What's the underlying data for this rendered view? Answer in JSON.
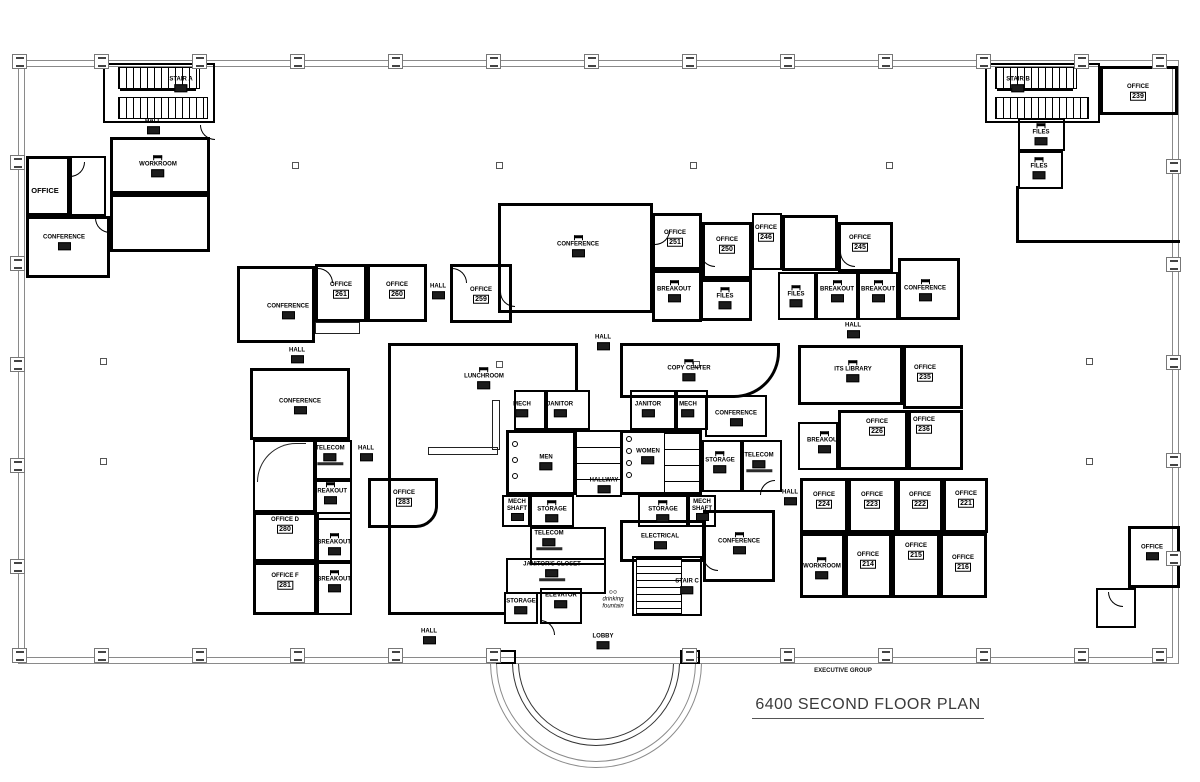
{
  "meta": {
    "title": "6400 SECOND FLOOR PLAN",
    "building_label": "EXECUTIVE GROUP"
  },
  "plan": {
    "labels": [
      {
        "name": "STAIR A",
        "x": 181,
        "y": 84,
        "num": ""
      },
      {
        "name": "HALL",
        "x": 153,
        "y": 126,
        "num": ""
      },
      {
        "name": "WORKROOM",
        "x": 158,
        "y": 166,
        "num": "",
        "icon": "desk"
      },
      {
        "name": "OFFICE",
        "x": 45,
        "y": 191,
        "big": true
      },
      {
        "name": "CONFERENCE",
        "x": 64,
        "y": 242,
        "num": ""
      },
      {
        "name": "STAIR B",
        "x": 1018,
        "y": 84,
        "num": ""
      },
      {
        "name": "OFFICE",
        "x": 1138,
        "y": 92,
        "num": "239"
      },
      {
        "name": "FILES",
        "x": 1041,
        "y": 134,
        "num": "",
        "icon": "desk"
      },
      {
        "name": "FILES",
        "x": 1039,
        "y": 168,
        "num": "",
        "icon": "desk"
      },
      {
        "name": "CONFERENCE",
        "x": 288,
        "y": 311,
        "num": ""
      },
      {
        "name": "OFFICE",
        "x": 341,
        "y": 290,
        "num": "261"
      },
      {
        "name": "OFFICE",
        "x": 397,
        "y": 290,
        "num": "260"
      },
      {
        "name": "HALL",
        "x": 438,
        "y": 291,
        "num": ""
      },
      {
        "name": "OFFICE",
        "x": 481,
        "y": 295,
        "num": "259"
      },
      {
        "name": "HALL",
        "x": 297,
        "y": 355,
        "num": ""
      },
      {
        "name": "CONFERENCE",
        "x": 300,
        "y": 406,
        "num": ""
      },
      {
        "name": "TELECOM",
        "x": 330,
        "y": 455,
        "num": "",
        "sub": true
      },
      {
        "name": "BREAKOUT",
        "x": 330,
        "y": 493,
        "num": "",
        "icon": "desk"
      },
      {
        "name": "OFFICE D",
        "x": 285,
        "y": 525,
        "num": "280"
      },
      {
        "name": "BREAKOUT",
        "x": 334,
        "y": 544,
        "num": "",
        "icon": "desk"
      },
      {
        "name": "OFFICE F",
        "x": 285,
        "y": 581,
        "num": "281"
      },
      {
        "name": "BREAKOUT",
        "x": 334,
        "y": 581,
        "num": "",
        "icon": "desk"
      },
      {
        "name": "HALL",
        "x": 366,
        "y": 453,
        "num": ""
      },
      {
        "name": "OFFICE",
        "x": 404,
        "y": 498,
        "num": "283"
      },
      {
        "name": "CONFERENCE",
        "x": 578,
        "y": 246,
        "num": "",
        "icon": "desk"
      },
      {
        "name": "LUNCHROOM",
        "x": 484,
        "y": 378,
        "num": "",
        "icon": "desk"
      },
      {
        "name": "COPY CENTER",
        "x": 689,
        "y": 370,
        "num": "",
        "icon": "desk"
      },
      {
        "name": "HALL",
        "x": 603,
        "y": 342,
        "num": ""
      },
      {
        "name": "MECH",
        "x": 522,
        "y": 409,
        "num": ""
      },
      {
        "name": "JANITOR",
        "x": 560,
        "y": 409,
        "num": ""
      },
      {
        "name": "JANITOR",
        "x": 648,
        "y": 409,
        "num": ""
      },
      {
        "name": "MECH",
        "x": 688,
        "y": 409,
        "num": ""
      },
      {
        "name": "MEN",
        "x": 546,
        "y": 462,
        "num": ""
      },
      {
        "name": "WOMEN",
        "x": 648,
        "y": 456,
        "num": ""
      },
      {
        "name": "HALLWAY",
        "x": 604,
        "y": 485,
        "num": ""
      },
      {
        "name": "CONFERENCE",
        "x": 736,
        "y": 418,
        "num": ""
      },
      {
        "name": "STORAGE",
        "x": 720,
        "y": 462,
        "num": "",
        "icon": "desk"
      },
      {
        "name": "TELECOM",
        "x": 759,
        "y": 462,
        "num": "",
        "sub": true
      },
      {
        "name": "MECH\nSHAFT",
        "x": 517,
        "y": 510,
        "num": ""
      },
      {
        "name": "STORAGE",
        "x": 552,
        "y": 511,
        "num": "",
        "icon": "desk"
      },
      {
        "name": "STORAGE",
        "x": 663,
        "y": 511,
        "num": "",
        "icon": "desk"
      },
      {
        "name": "MECH\nSHAFT",
        "x": 702,
        "y": 510,
        "num": ""
      },
      {
        "name": "TELECOM",
        "x": 549,
        "y": 540,
        "num": "",
        "sub": true
      },
      {
        "name": "ELECTRICAL",
        "x": 660,
        "y": 541,
        "num": ""
      },
      {
        "name": "JANITOR'S CLOSET",
        "x": 552,
        "y": 571,
        "num": "",
        "sub": true
      },
      {
        "name": "ELEVATOR",
        "x": 561,
        "y": 600,
        "num": ""
      },
      {
        "name": "drinking\nfountain",
        "x": 613,
        "y": 600,
        "note": true,
        "icon": "fountain"
      },
      {
        "name": "STORAGE",
        "x": 521,
        "y": 606,
        "num": ""
      },
      {
        "name": "STAIR C",
        "x": 687,
        "y": 586,
        "num": ""
      },
      {
        "name": "CONFERENCE",
        "x": 739,
        "y": 543,
        "num": "",
        "icon": "desk"
      },
      {
        "name": "LOBBY",
        "x": 603,
        "y": 641,
        "num": ""
      },
      {
        "name": "HALL",
        "x": 429,
        "y": 636,
        "num": ""
      },
      {
        "name": "OFFICE",
        "x": 675,
        "y": 238,
        "num": "251"
      },
      {
        "name": "BREAKOUT",
        "x": 674,
        "y": 291,
        "num": "",
        "icon": "desk"
      },
      {
        "name": "OFFICE",
        "x": 727,
        "y": 245,
        "num": "250"
      },
      {
        "name": "FILES",
        "x": 725,
        "y": 298,
        "num": "",
        "icon": "desk"
      },
      {
        "name": "OFFICE",
        "x": 766,
        "y": 233,
        "num": "246"
      },
      {
        "name": "OFFICE",
        "x": 860,
        "y": 243,
        "num": "245"
      },
      {
        "name": "FILES",
        "x": 796,
        "y": 296,
        "num": "",
        "icon": "desk"
      },
      {
        "name": "BREAKOUT",
        "x": 837,
        "y": 291,
        "num": "",
        "icon": "desk"
      },
      {
        "name": "BREAKOUT",
        "x": 878,
        "y": 291,
        "num": "",
        "icon": "desk"
      },
      {
        "name": "CONFERENCE",
        "x": 925,
        "y": 290,
        "num": "",
        "icon": "desk"
      },
      {
        "name": "HALL",
        "x": 853,
        "y": 330,
        "num": ""
      },
      {
        "name": "ITS LIBRARY",
        "x": 853,
        "y": 371,
        "num": "",
        "icon": "desk"
      },
      {
        "name": "OFFICE",
        "x": 925,
        "y": 373,
        "num": "235"
      },
      {
        "name": "BREAKOUT",
        "x": 824,
        "y": 442,
        "num": "",
        "icon": "desk"
      },
      {
        "name": "OFFICE",
        "x": 877,
        "y": 427,
        "num": "226"
      },
      {
        "name": "OFFICE",
        "x": 924,
        "y": 425,
        "num": "236"
      },
      {
        "name": "HALL",
        "x": 790,
        "y": 497,
        "num": ""
      },
      {
        "name": "OFFICE",
        "x": 824,
        "y": 500,
        "num": "224"
      },
      {
        "name": "OFFICE",
        "x": 872,
        "y": 500,
        "num": "223"
      },
      {
        "name": "OFFICE",
        "x": 920,
        "y": 500,
        "num": "222"
      },
      {
        "name": "OFFICE",
        "x": 966,
        "y": 499,
        "num": "221"
      },
      {
        "name": "WORKROOM",
        "x": 822,
        "y": 568,
        "num": "",
        "icon": "desk"
      },
      {
        "name": "OFFICE",
        "x": 868,
        "y": 560,
        "num": "214"
      },
      {
        "name": "OFFICE",
        "x": 916,
        "y": 551,
        "num": "215"
      },
      {
        "name": "OFFICE",
        "x": 963,
        "y": 563,
        "num": "216"
      },
      {
        "name": "OFFICE",
        "x": 1152,
        "y": 552,
        "num": ""
      }
    ]
  }
}
